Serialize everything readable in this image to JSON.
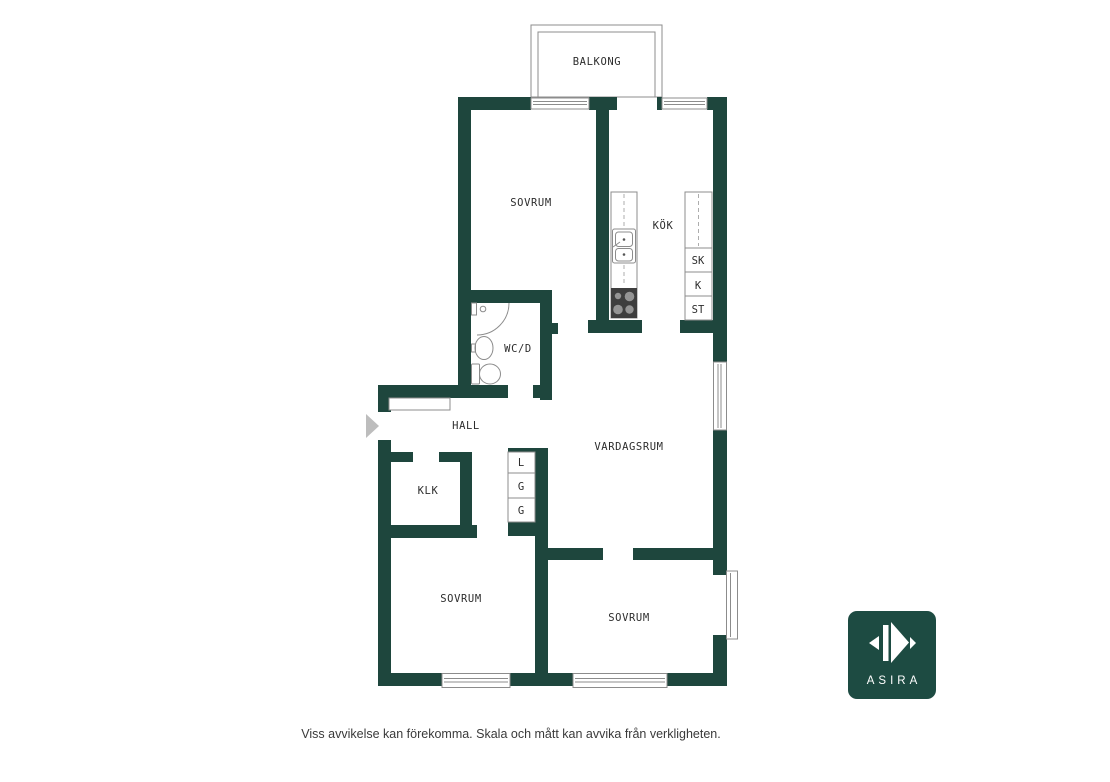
{
  "floorplan": {
    "balcony": "BALKONG",
    "rooms": {
      "bedroom_top": "SOVRUM",
      "kitchen": "KÖK",
      "wc": "WC/D",
      "hall": "HALL",
      "living_room": "VARDAGSRUM",
      "closet_room": "KLK",
      "bedroom_left": "SOVRUM",
      "bedroom_right": "SOVRUM"
    },
    "storage": {
      "sk": "SK",
      "k": "K",
      "st": "ST",
      "l": "L",
      "g1": "G",
      "g2": "G"
    }
  },
  "branding": {
    "logo_text": "ASIRA"
  },
  "footer": {
    "disclaimer": "Viss avvikelse kan förekomma. Skala och mått kan avvika från verkligheten."
  },
  "colors": {
    "wall": "#1E463D",
    "logo_bg": "#1D4B42",
    "line": "#8C8C8C",
    "line_light": "#ADADAD",
    "text": "#2D2D2D",
    "footer_text": "#3A3A3A",
    "stove": "#3E3E3E",
    "burner": "#949494",
    "arrow": "#BDBDBD"
  }
}
